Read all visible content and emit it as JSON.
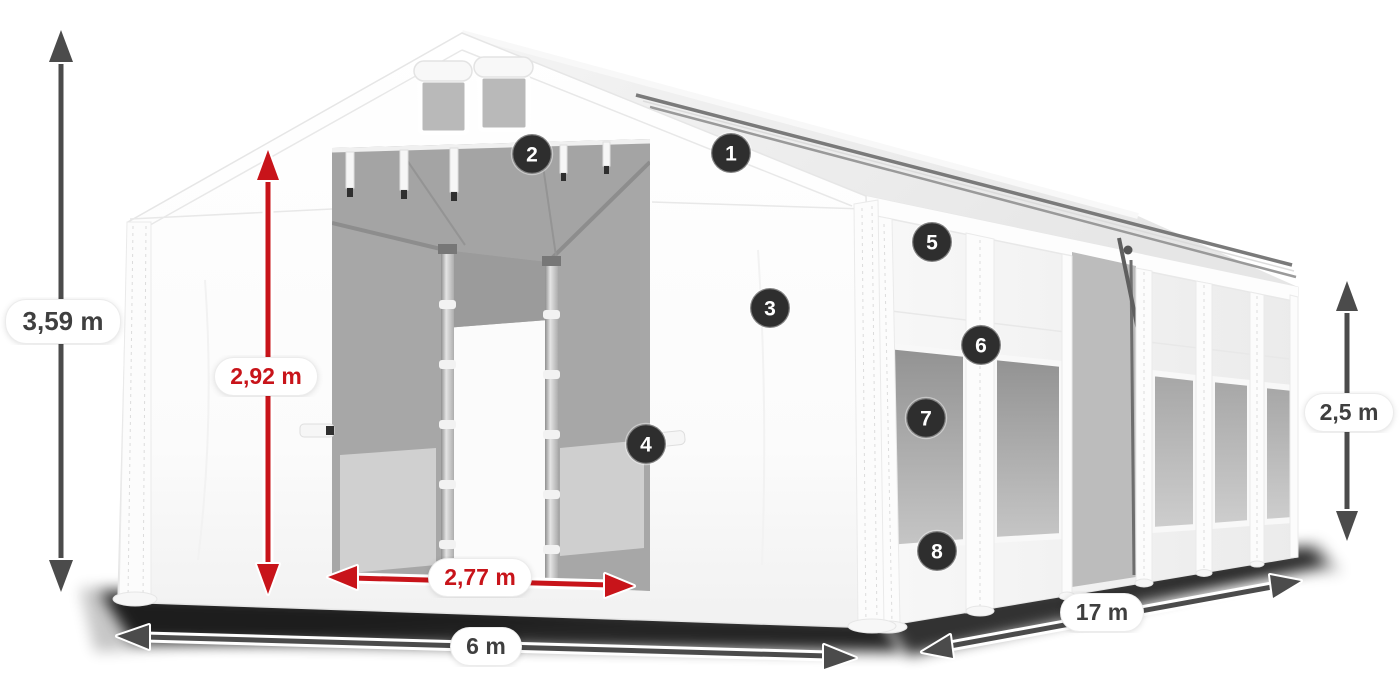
{
  "diagram": {
    "background": "#ffffff",
    "badges": [
      {
        "label": "1"
      },
      {
        "label": "2"
      },
      {
        "label": "3"
      },
      {
        "label": "4"
      },
      {
        "label": "5"
      },
      {
        "label": "6"
      },
      {
        "label": "7"
      },
      {
        "label": "8"
      }
    ],
    "dimensions": {
      "total_height": "3,59 m",
      "entrance_height": "2,92 m",
      "entrance_width": "2,77 m",
      "front_width": "6 m",
      "side_length": "17 m",
      "side_height": "2,5 m"
    },
    "colors": {
      "dimension_red": "#c8141a",
      "dimension_gray": "#4b4b4b",
      "badge_background": "#2e2e2e",
      "badge_text": "#ffffff",
      "label_background": "#ffffff",
      "label_text": "#3f3f3f"
    }
  }
}
